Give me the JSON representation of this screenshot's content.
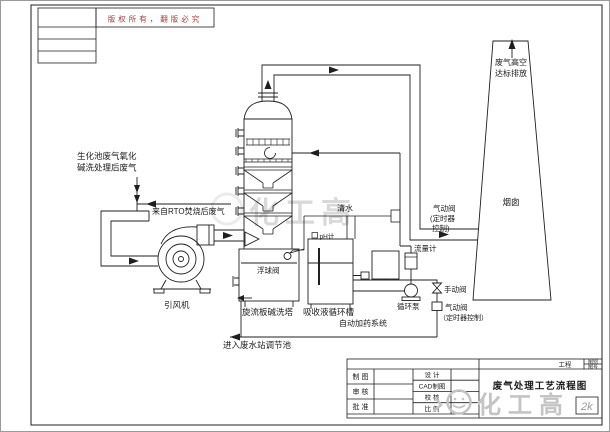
{
  "copyright_notice": "版权所有，翻版必究",
  "flow_labels": {
    "inlet_biochem_1": "生化池废气氧化",
    "inlet_biochem_2": "碱洗处理后废气",
    "inlet_rto": "来自RTO焚烧后废气",
    "fan": "引风机",
    "tower": "旋流板碱洗塔",
    "float_valve": "浮球阀",
    "ph_meter": "pH计",
    "circulation_tank": "吸收液循环槽",
    "dosing_system": "自动加药系统",
    "to_wastewater": "进入废水站调节池",
    "fresh_water": "清水",
    "pneumatic_valve_upper_1": "气动阀",
    "pneumatic_valve_upper_2": "(定时器",
    "pneumatic_valve_upper_3": "控制)",
    "flow_meter": "流量计",
    "manual_valve": "手动阀",
    "circulation_pump": "循环泵",
    "pneumatic_valve_lower_1": "气动阀",
    "pneumatic_valve_lower_2": "（定时器控制）",
    "stack_out_1": "废气高空",
    "stack_out_2": "达标排放",
    "chimney": "烟囱"
  },
  "title_block": {
    "project_label": "工程",
    "drawing_title": "废气处理工艺流程图",
    "left_rows": [
      "制 图",
      "审 核",
      "批 准"
    ],
    "mid_rows": [
      "设 计",
      "CAD制图",
      "校 核",
      "比 例"
    ],
    "sheet_cell_top": "图别",
    "sheet_cell_bottom": "图号",
    "corner_mark": "2k"
  },
  "watermark": {
    "brand": "化工高",
    "mark": "2k"
  },
  "colors": {
    "line": "#1f1f1f",
    "copyright_red": "#a23b32",
    "watermark_gray": "#c4c4c4"
  }
}
